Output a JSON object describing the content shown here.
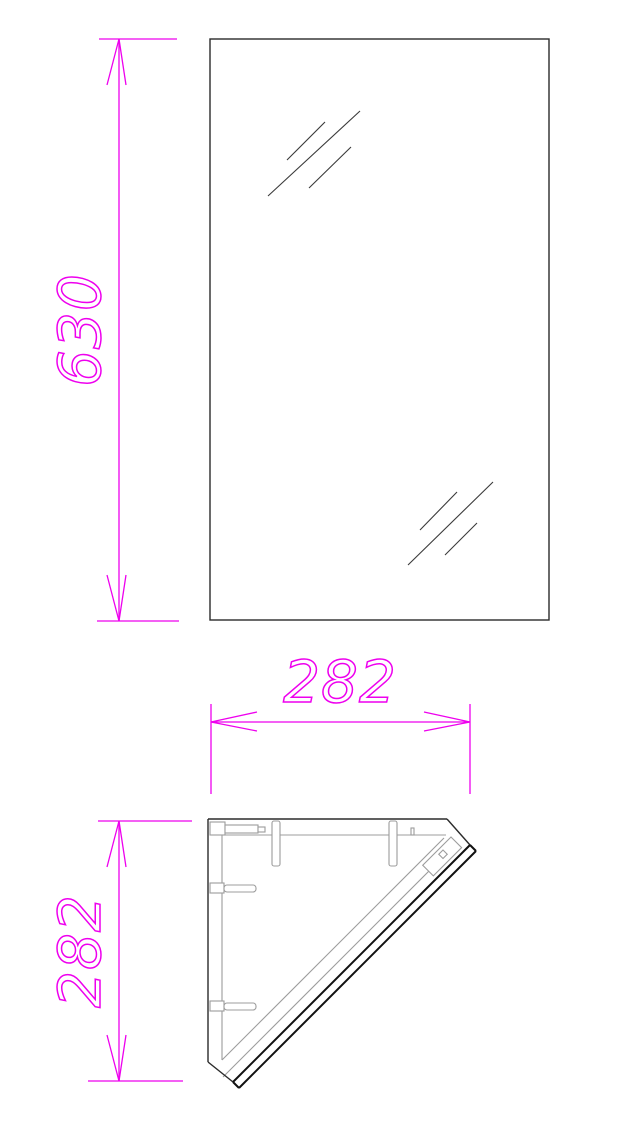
{
  "drawing": {
    "dimensions": {
      "mirror_height": "630",
      "cabinet_width": "282",
      "cabinet_depth": "282"
    },
    "colors": {
      "dimension_lines": "#ee00ee",
      "main_outline": "#2b2b2b",
      "inner_detail": "#9c9c9c",
      "door_edge": "#111111",
      "background": "#ffffff"
    }
  }
}
